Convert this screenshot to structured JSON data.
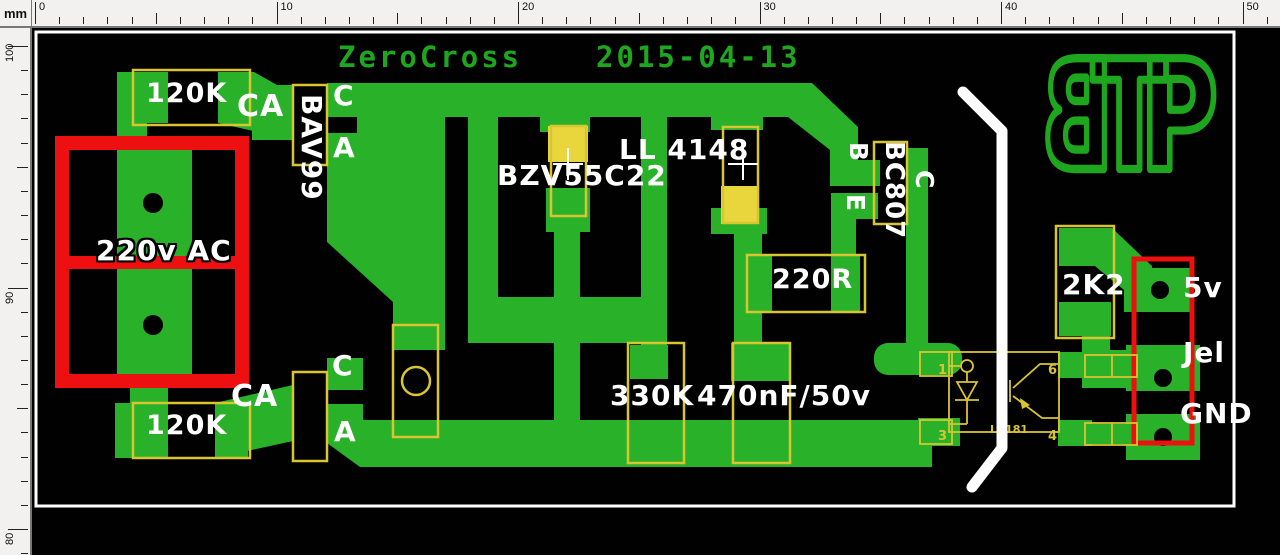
{
  "ruler": {
    "unit": "mm",
    "horizontal_labels": [
      "0",
      "10",
      "20",
      "30",
      "40",
      "50"
    ],
    "vertical_labels": [
      "100",
      "90",
      "80"
    ]
  },
  "title": {
    "project": "ZeroCross",
    "date": "2015-04-13"
  },
  "logo": {
    "letters": [
      "B",
      "T",
      "P"
    ]
  },
  "colors": {
    "copper": "#29b129",
    "silk_yellow": "#d9c531",
    "paint_yellow": "#e8d63c",
    "red": "#ee1010",
    "green_text": "#1ea71e",
    "white": "#ffffff",
    "board": "#000000",
    "ruler_bg": "#f2f1ef"
  },
  "silkscreen_labels": [
    {
      "text": "120K",
      "x": 146,
      "y": 80,
      "size": 27,
      "rot": 0
    },
    {
      "text": "CA",
      "x": 237,
      "y": 92,
      "size": 30,
      "rot": 0
    },
    {
      "text": "BAV99",
      "x": 325,
      "y": 94,
      "size": 28,
      "rot": 90
    },
    {
      "text": "C",
      "x": 333,
      "y": 82,
      "size": 28,
      "rot": 0
    },
    {
      "text": "A",
      "x": 333,
      "y": 134,
      "size": 28,
      "rot": 0
    },
    {
      "text": "BZV55C22",
      "x": 497,
      "y": 162,
      "size": 28,
      "rot": 0
    },
    {
      "text": "LL 4148",
      "x": 619,
      "y": 136,
      "size": 28,
      "rot": 0
    },
    {
      "text": "B",
      "x": 871,
      "y": 142,
      "size": 25,
      "rot": 90
    },
    {
      "text": "E",
      "x": 868,
      "y": 194,
      "size": 25,
      "rot": 90
    },
    {
      "text": "BC807",
      "x": 907,
      "y": 141,
      "size": 26,
      "rot": 90
    },
    {
      "text": "C",
      "x": 937,
      "y": 170,
      "size": 25,
      "rot": 90
    },
    {
      "text": "220R",
      "x": 772,
      "y": 266,
      "size": 27,
      "rot": 0
    },
    {
      "text": "330K",
      "x": 610,
      "y": 382,
      "size": 28,
      "rot": 0
    },
    {
      "text": "470nF/50v",
      "x": 697,
      "y": 382,
      "size": 28,
      "rot": 0
    },
    {
      "text": "2K2",
      "x": 1062,
      "y": 271,
      "size": 28,
      "rot": 0
    },
    {
      "text": "5v",
      "x": 1183,
      "y": 274,
      "size": 28,
      "rot": 0
    },
    {
      "text": "Jel",
      "x": 1183,
      "y": 339,
      "size": 28,
      "rot": 0
    },
    {
      "text": "GND",
      "x": 1180,
      "y": 400,
      "size": 28,
      "rot": 0
    },
    {
      "text": "220v AC",
      "x": 96,
      "y": 237,
      "size": 28,
      "rot": 0,
      "outlined": true
    },
    {
      "text": "120K",
      "x": 146,
      "y": 412,
      "size": 27,
      "rot": 0
    },
    {
      "text": "CA",
      "x": 231,
      "y": 382,
      "size": 30,
      "rot": 0
    },
    {
      "text": "C",
      "x": 332,
      "y": 352,
      "size": 28,
      "rot": 0
    },
    {
      "text": "A",
      "x": 334,
      "y": 418,
      "size": 28,
      "rot": 0
    }
  ],
  "optocoupler": {
    "ref": "LP181",
    "pin_numbers": [
      "1",
      "3",
      "6",
      "4"
    ]
  }
}
